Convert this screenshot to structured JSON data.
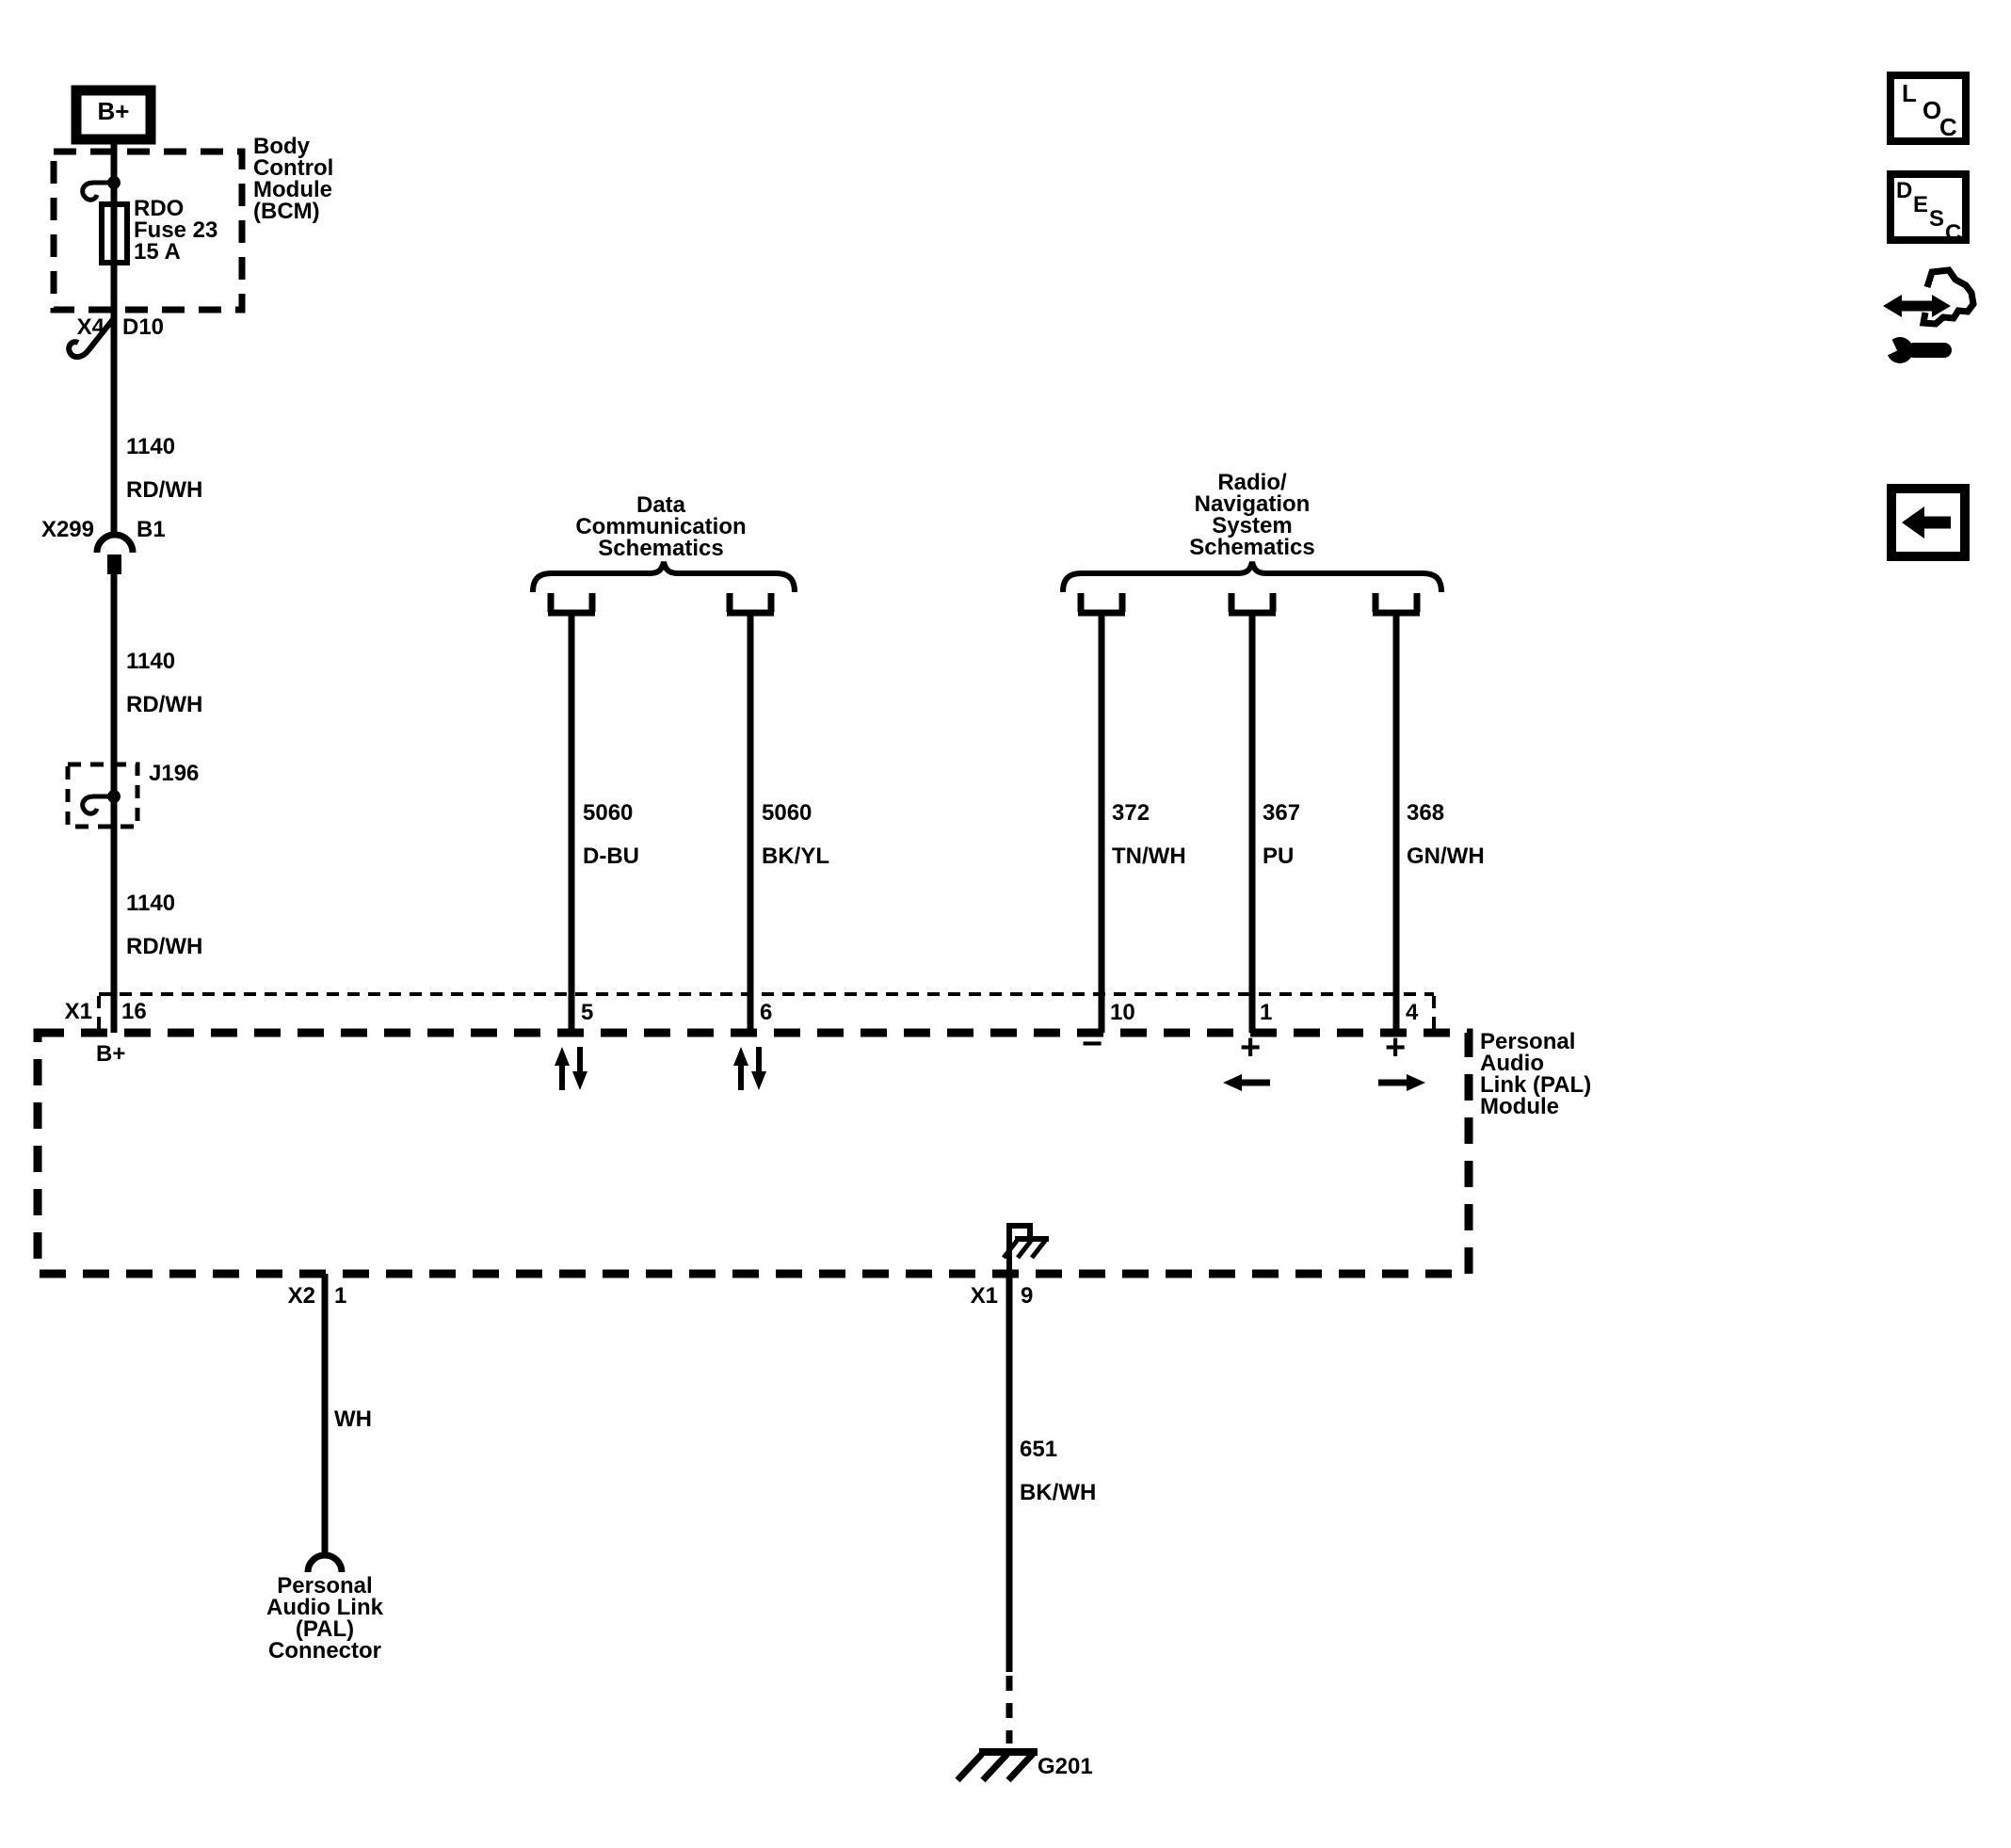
{
  "toolbar": {
    "loc_letters": [
      "L",
      "O",
      "C"
    ],
    "desc_letters": [
      "D",
      "E",
      "S",
      "C"
    ]
  },
  "power_feed": {
    "battery_label": "B+",
    "bcm_label": "Body\nControl\nModule\n(BCM)",
    "fuse_label": "RDO\nFuse 23\n15 A",
    "connector_x4": "X4",
    "pin_d10": "D10",
    "wire_a": {
      "circuit": "1140",
      "color": "RD/WH"
    },
    "connector_x299": "X299",
    "pin_b1": "B1",
    "wire_b": {
      "circuit": "1140",
      "color": "RD/WH"
    },
    "splice": "J196",
    "wire_c": {
      "circuit": "1140",
      "color": "RD/WH"
    },
    "connector_x1": "X1",
    "pin_16": "16",
    "module_b_plus": "B+"
  },
  "data_comm": {
    "header": "Data\nCommunication\nSchematics",
    "wires": [
      {
        "circuit": "5060",
        "color": "D-BU",
        "pin": "5"
      },
      {
        "circuit": "5060",
        "color": "BK/YL",
        "pin": "6"
      }
    ]
  },
  "radio_nav": {
    "header": "Radio/\nNavigation\nSystem\nSchematics",
    "wires": [
      {
        "circuit": "372",
        "color": "TN/WH",
        "pin": "10",
        "sign": "−"
      },
      {
        "circuit": "367",
        "color": "PU",
        "pin": "1",
        "sign": "+"
      },
      {
        "circuit": "368",
        "color": "GN/WH",
        "pin": "4",
        "sign": "+"
      }
    ]
  },
  "pal_module": {
    "label": "Personal\nAudio\nLink (PAL)\nModule"
  },
  "outputs": {
    "connector_x2": "X2",
    "pin_1": "1",
    "wire_wh": "WH",
    "pal_connector_label": "Personal\nAudio Link\n(PAL)\nConnector",
    "connector_x1": "X1",
    "pin_9": "9",
    "wire_651": {
      "circuit": "651",
      "color": "BK/WH"
    },
    "ground_label": "G201"
  },
  "colors": {
    "ink": "#000000",
    "paper": "#ffffff"
  }
}
